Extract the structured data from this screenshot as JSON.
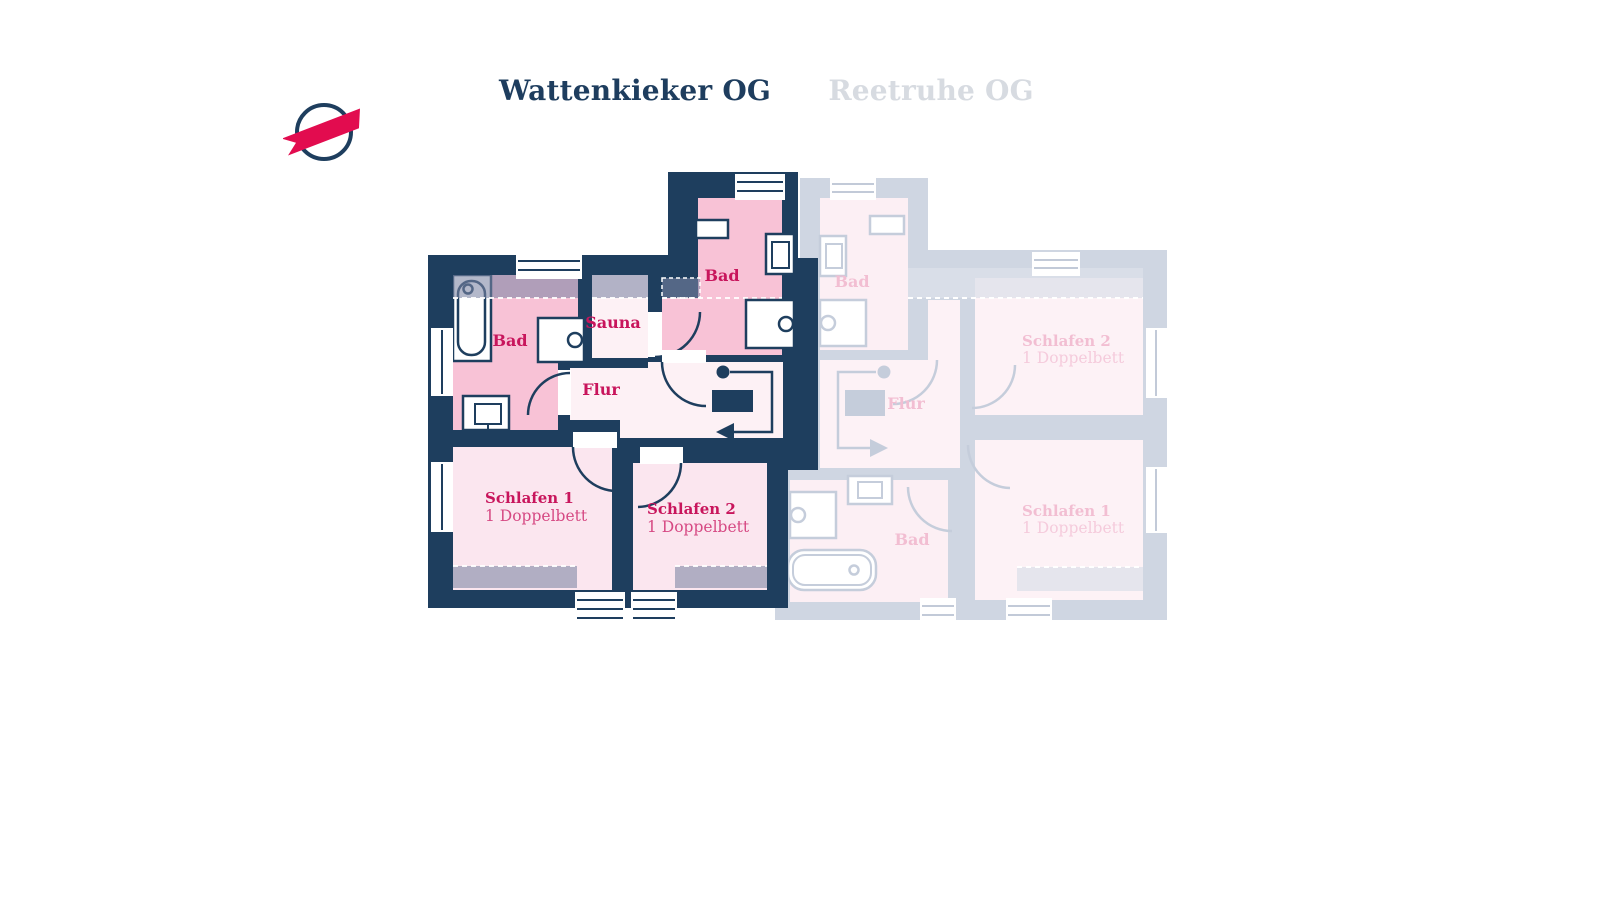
{
  "tabs": [
    {
      "label": "Wattenkieker OG",
      "active": true
    },
    {
      "label": "Reetruhe OG",
      "active": false
    }
  ],
  "logo": {
    "name": "brand-logo",
    "circle_color": "#1e3e5e",
    "ribbon_color": "#e20c4f"
  },
  "colors": {
    "wall_active": "#1e3e5e",
    "wall_faded": "#cfd6e2",
    "bath_pink": "#f8c2d6",
    "room_light_pink": "#fdf1f5",
    "bedroom_pink": "#fbe6ef",
    "label_crimson": "#c8155c",
    "label_faded_pink": "#f2bed2",
    "slope_band_gray": "#8c94a8"
  },
  "active_plan": {
    "title": "Wattenkieker OG",
    "rooms": {
      "bad_left": {
        "label": "Bad"
      },
      "sauna": {
        "label": "Sauna"
      },
      "bad_top": {
        "label": "Bad"
      },
      "flur": {
        "label": "Flur"
      },
      "schlafen1": {
        "label": "Schlafen 1",
        "beds": "1 Doppelbett"
      },
      "schlafen2": {
        "label": "Schlafen 2",
        "beds": "1 Doppelbett"
      }
    }
  },
  "faded_plan": {
    "title": "Reetruhe OG",
    "rooms": {
      "bad_top": {
        "label": "Bad"
      },
      "flur": {
        "label": "Flur"
      },
      "bad_bottom": {
        "label": "Bad"
      },
      "schlafen1": {
        "label": "Schlafen 1",
        "beds": "1 Doppelbett"
      },
      "schlafen2": {
        "label": "Schlafen 2",
        "beds": "1 Doppelbett"
      }
    }
  }
}
